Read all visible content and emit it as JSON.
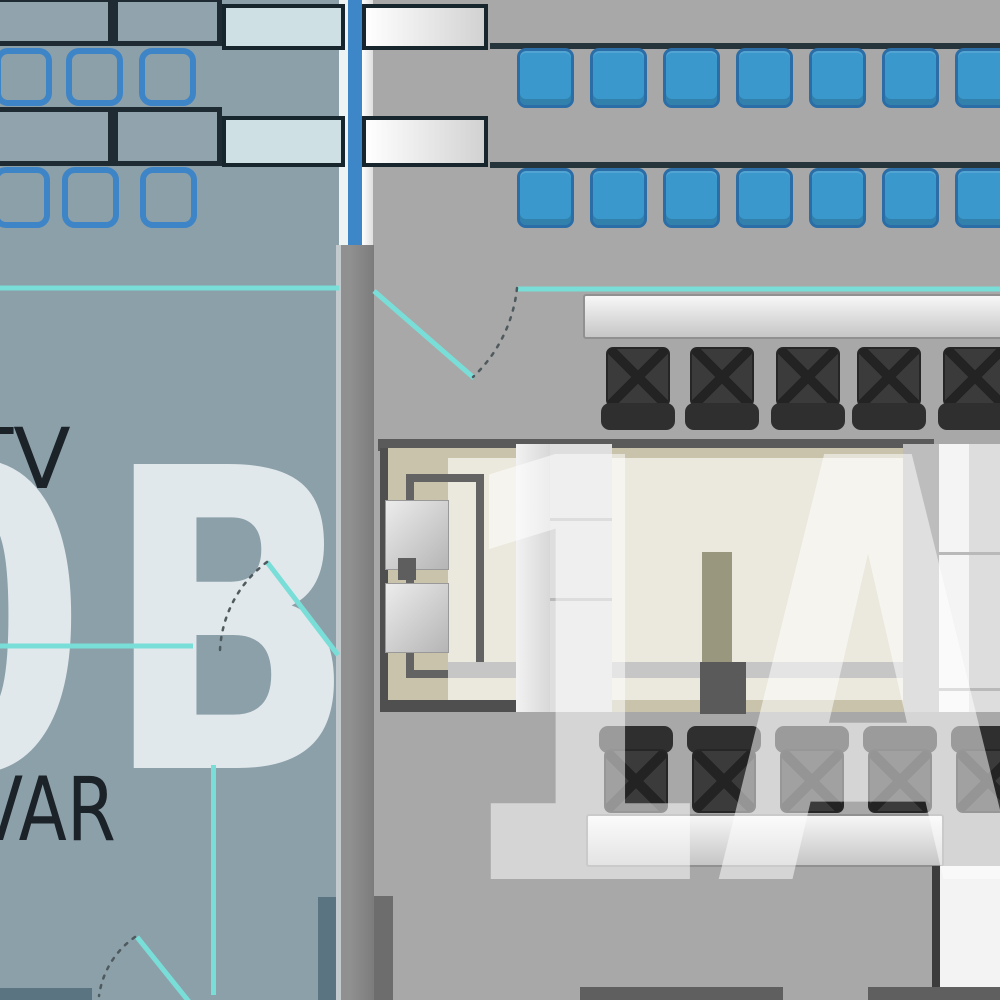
{
  "plan": {
    "labels": {
      "room_tv": "TV",
      "room_var": "VAR",
      "zone_left_watermark": "0B",
      "zone_right_watermark": "1A"
    },
    "colors": {
      "left_room_bg": "#8ca0aa",
      "right_room_bg": "#a8a8a8",
      "glass_wall_blue": "#3d87c9",
      "teal_partition": "#79ded8",
      "blue_seat": "#3b98cc",
      "chair_outline_blue": "#3e85c7",
      "dark_chair": "#3b3b3b",
      "beige_rug": "#c9c3ac",
      "cream_table": "#ebe9dd",
      "pale_table_fill": "#cfe0e5",
      "table_border": "#17252c",
      "wall_gray": "#8a8a8a",
      "watermark_left_color": "#e9eef1",
      "label_text_color": "#1b2228"
    },
    "fixtures": {
      "left_room_tables": 4,
      "left_room_side_tables": 2,
      "right_room_side_tables": 2,
      "chair_outline_rows": [
        3,
        3
      ],
      "blue_seat_rows": [
        7,
        7
      ],
      "dark_chairs_top": 5,
      "dark_chairs_bottom": 5,
      "benches": 2,
      "door_swings": 3
    }
  }
}
